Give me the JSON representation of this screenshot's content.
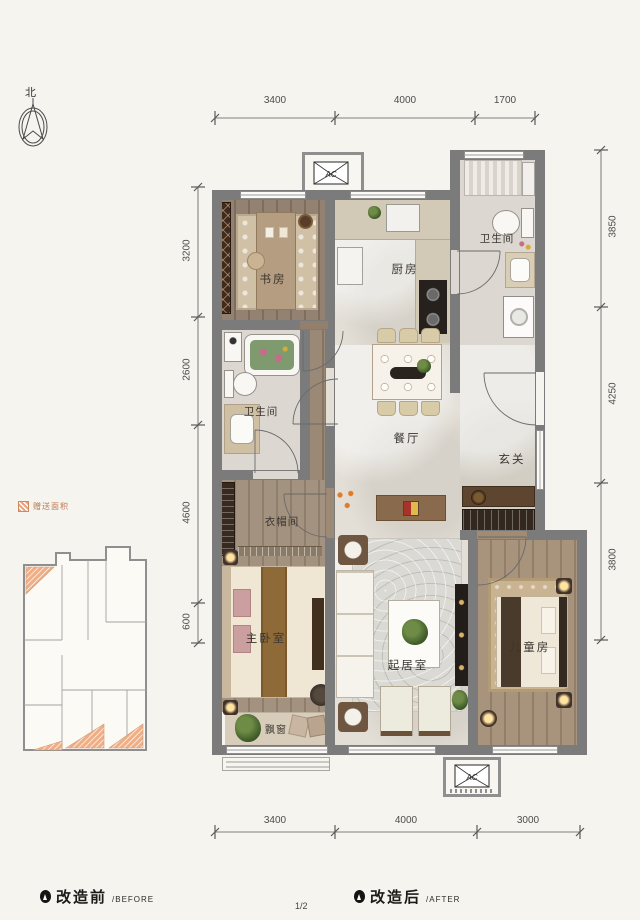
{
  "north_label": "北",
  "legend": {
    "gift_area_label": "赠送面积"
  },
  "dims": {
    "top": [
      "3400",
      "4000",
      "1700"
    ],
    "bottom": [
      "3400",
      "4000",
      "3000"
    ],
    "left": [
      "3200",
      "2600",
      "4600",
      "600"
    ],
    "right": [
      "3850",
      "4250",
      "3800"
    ]
  },
  "rooms": {
    "study": "书房",
    "kitchen": "厨房",
    "bath_top": "卫生间",
    "bath_left": "卫生间",
    "dining": "餐厅",
    "entry": "玄关",
    "cloak": "衣帽间",
    "master": "主卧室",
    "living": "起居室",
    "kids": "儿童房",
    "bay": "飘窗"
  },
  "ac_label": "AC",
  "captions": {
    "before_cn": "改造前",
    "before_en": "/BEFORE",
    "after_cn": "改造后",
    "after_en": "/AFTER"
  },
  "page_number": "1/2",
  "colors": {
    "accent_orange": "#E8A47E",
    "wall_gray": "#7B7B7B"
  }
}
